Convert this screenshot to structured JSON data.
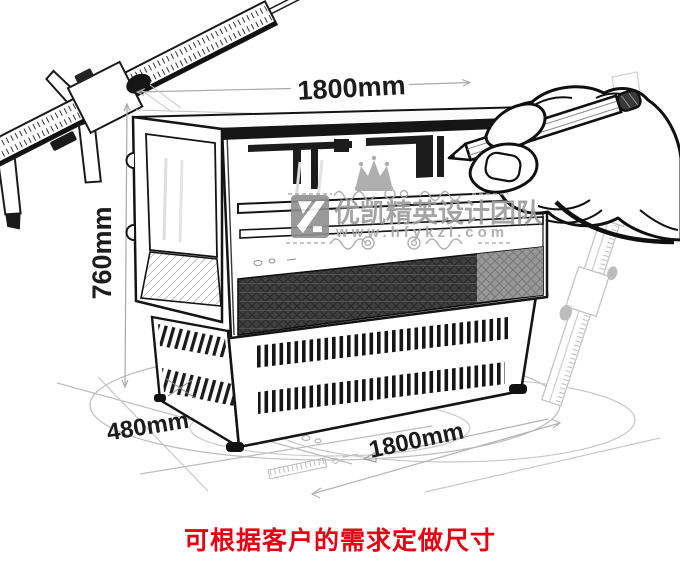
{
  "diagram": {
    "type": "product-dimension-sketch",
    "product": "display-cabinet"
  },
  "labels": {
    "top_width": "1800mm",
    "height": "760mm",
    "depth": "480mm",
    "bottom_width": "1800mm"
  },
  "watermark": {
    "brand": "优凯精英设计团队",
    "url": "www.hfykzl.com"
  },
  "caption": "可根据客户的需求定做尺寸",
  "colors": {
    "caption_red": "#e60012",
    "ink": "#1c1c1c",
    "guide_gray": "#b3b3b3",
    "watermark_gray": "#9b9b9b"
  },
  "illustration": {
    "parts": [
      {
        "name": "vernier-caliper",
        "position": "top-left"
      },
      {
        "name": "hand-with-pencil",
        "position": "top-right"
      },
      {
        "name": "display-cabinet-sketch",
        "position": "center"
      },
      {
        "name": "steel-ruler",
        "position": "right"
      },
      {
        "name": "ground-ellipse-guides",
        "position": "bottom"
      }
    ]
  }
}
